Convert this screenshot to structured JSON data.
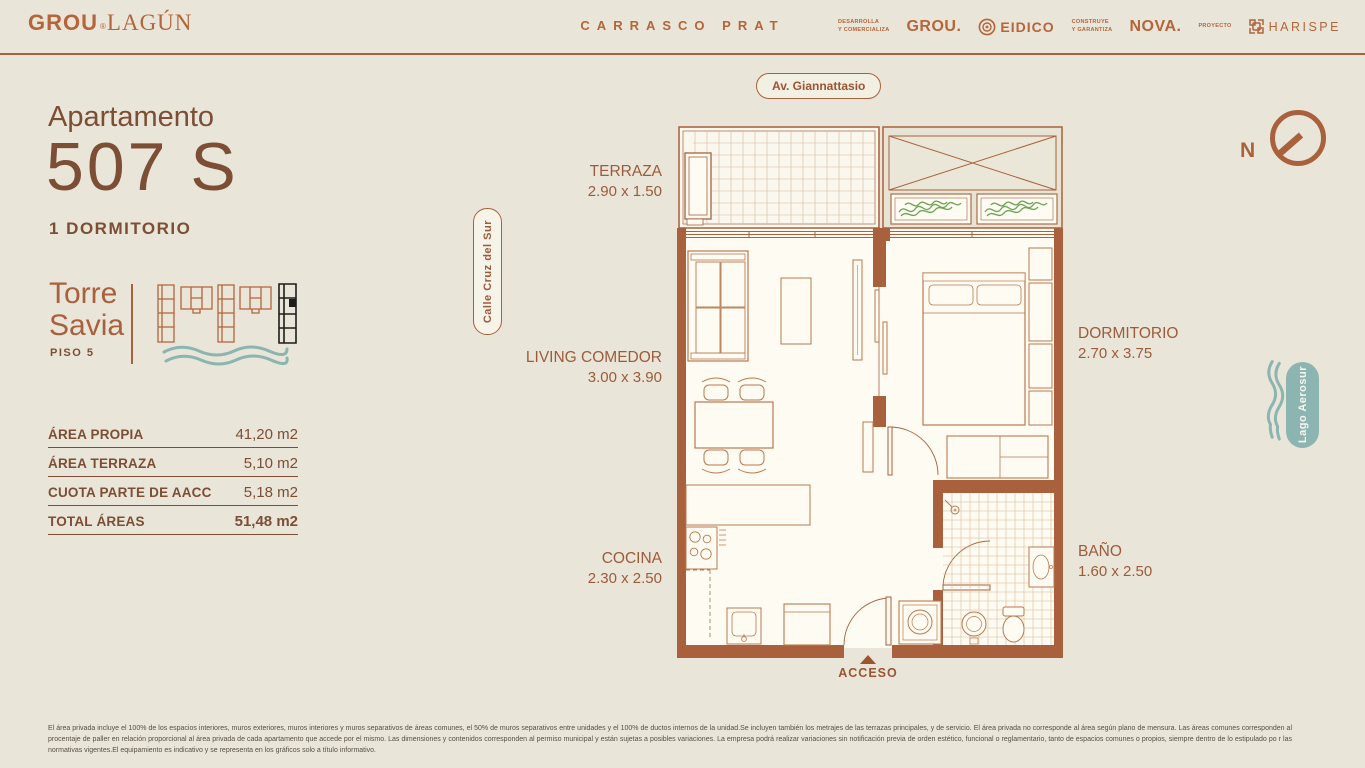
{
  "header": {
    "logo": {
      "grou": "GROU",
      "reg": "®",
      "lagun": "LAGÚN"
    },
    "project_name": "CARRASCO PRAT",
    "partners": {
      "dev_role": "DESARROLLA\nY COMERCIALIZA",
      "dev_name": "GROU.",
      "eidico_name": "EIDICO",
      "build_role": "CONSTRUYE\nY GARANTIZA",
      "build_name": "NOVA.",
      "project_role": "PROYECTO",
      "project_name": "HARISPE"
    }
  },
  "unit": {
    "label": "Apartamento",
    "number": "507 S",
    "type": "1 DORMITORIO",
    "tower": "Torre Savia",
    "floor": "PISO 5"
  },
  "areas": {
    "rows": [
      {
        "label": "ÁREA PROPIA",
        "value": "41,20 m2"
      },
      {
        "label": "ÁREA TERRAZA",
        "value": "5,10 m2"
      },
      {
        "label": "CUOTA PARTE DE AACC",
        "value": "5,18 m2"
      },
      {
        "label": "TOTAL ÁREAS",
        "value": "51,48 m2"
      }
    ]
  },
  "plan": {
    "street_top": "Av. Giannattasio",
    "street_left": "Calle Cruz del Sur",
    "lake": "Lago Aerosur",
    "north": "N",
    "access": "ACCESO",
    "rooms": [
      {
        "name": "TERRAZA",
        "dims": "2.90 x 1.50"
      },
      {
        "name": "LIVING COMEDOR",
        "dims": "3.00 x 3.90"
      },
      {
        "name": "COCINA",
        "dims": "2.30 x 2.50"
      },
      {
        "name": "DORMITORIO",
        "dims": "2.70 x 3.75"
      },
      {
        "name": "BAÑO",
        "dims": "1.60 x 2.50"
      }
    ]
  },
  "footer": {
    "disclaimer": "El área privada incluye el 100% de los espacios interiores, muros exteriores, muros interiores y muros separativos de áreas comunes, el 50% de muros separativos entre unidades y el 100% de ductos internos de la unidad.Se incluyen también los metrajes de las terrazas principales, y de servicio. El área privada no corresponde al área según plano de mensura. Las áreas comunes corresponden al procentaje de paller en relación proporcional al área privada de cada apartamento que accede por el mismo. Las dimensiones y contenidos corresponden al permiso municipal y están sujetas a posibles variaciones. La empresa podrá realizar variaciones sin notificación previa de orden estético, funcional o reglamentario, tanto de espacios comunes o propios, siempre dentro de lo estipulado po r las normativas vigentes.El equipamiento es indicativo y se representa en los gráficos solo a título informativo."
  },
  "colors": {
    "background": "#e9e5d8",
    "accent_terracotta": "#a8613c",
    "text_brown": "#7c4e35",
    "furniture_line": "#b97a50",
    "teal_water": "#8cb5b1",
    "plant_green": "#6ca355",
    "plan_floor": "#fdfbf2",
    "fine_print": "#565041",
    "highlight_tower": "#1d1d1b"
  }
}
